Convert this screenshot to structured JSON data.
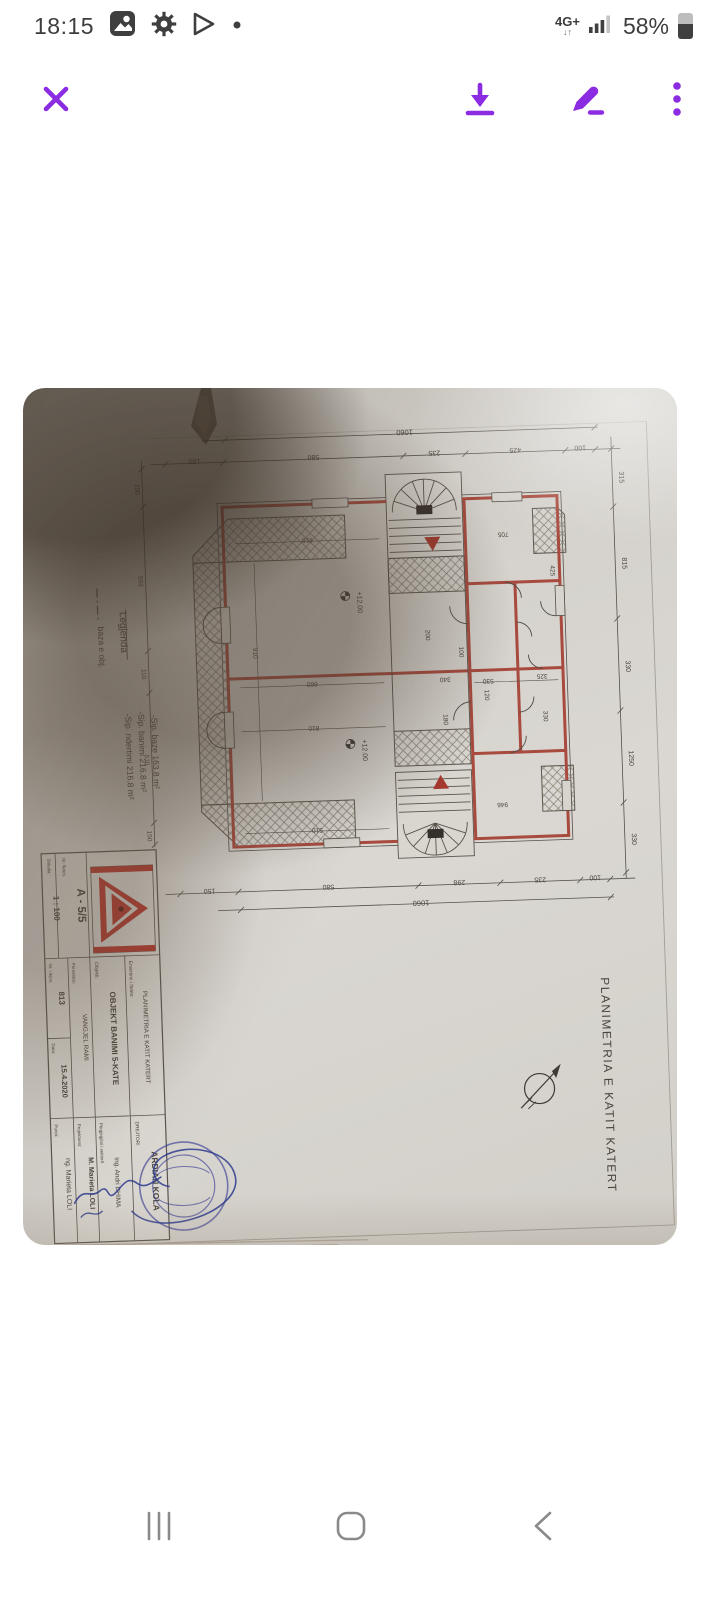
{
  "colors": {
    "accent": "#8b2be2",
    "wall_red": "#a84a3e",
    "stamp_blue": "#3b3f96"
  },
  "status_bar": {
    "time": "18:15",
    "network": "4G+",
    "battery": "58%"
  },
  "nav_bar": {
    "recents": "recents",
    "home": "home",
    "back": "back"
  },
  "photo": {
    "plan_title": "PLANIMETRIA E KATIT KATERT",
    "legend": {
      "title": "Legjenda",
      "line_item": "baza e obj.",
      "areas": [
        "-Sip. ndertimi 216.8 m²",
        "-Sip. banimi 216.8 m²",
        "-Sip. baze 163.8 m²"
      ]
    },
    "level_marks": [
      "+12.00",
      "+12.00"
    ],
    "dimensions": {
      "top_overall": "1060",
      "top": [
        "150",
        "580",
        "235",
        "425",
        "100"
      ],
      "bottom_overall": "1060",
      "bottom": [
        "150",
        "580",
        "298",
        "235",
        "100"
      ],
      "right": [
        "315",
        "815",
        "330",
        "1250",
        "330"
      ],
      "left": [
        "150",
        "593",
        "110",
        "570",
        "150"
      ],
      "interior": [
        "610",
        "910",
        "660",
        "810",
        "510",
        "340",
        "530",
        "200",
        "705",
        "425",
        "325",
        "330",
        "120",
        "180",
        "100",
        "946"
      ]
    },
    "title_block": {
      "scale_label": "Shkalla:",
      "scale": "1 : 100",
      "sheet_label": "Nr. fletës:",
      "sheet_no": "A - 5/5",
      "object_label": "Objekti:",
      "object_name": "OBJEKT BANIMI 5-KATE",
      "sheet_name_label": "Emërtimi i fletës:",
      "sheet_name": "PLANIMETRIA E KATIT KATERT",
      "client_label": "Porositësi:",
      "client": "VANGJEL RAMI",
      "permit_label": "Nr. i lejes:",
      "permit_no": "813",
      "date_label": "Data:",
      "date": "15.4.2020",
      "director_label": "DREJTORI",
      "director": "ARDIAN KOLA",
      "sector_label": "Përgjegjësi i sektorit",
      "sector_engineer": "Ing. Andri DHIMA",
      "designer_label": "Projektuesi:",
      "designer": "M. Marieta LOLI",
      "drafter_label": "Punoi:",
      "drafter": "ng. Marieta LOLI"
    }
  }
}
